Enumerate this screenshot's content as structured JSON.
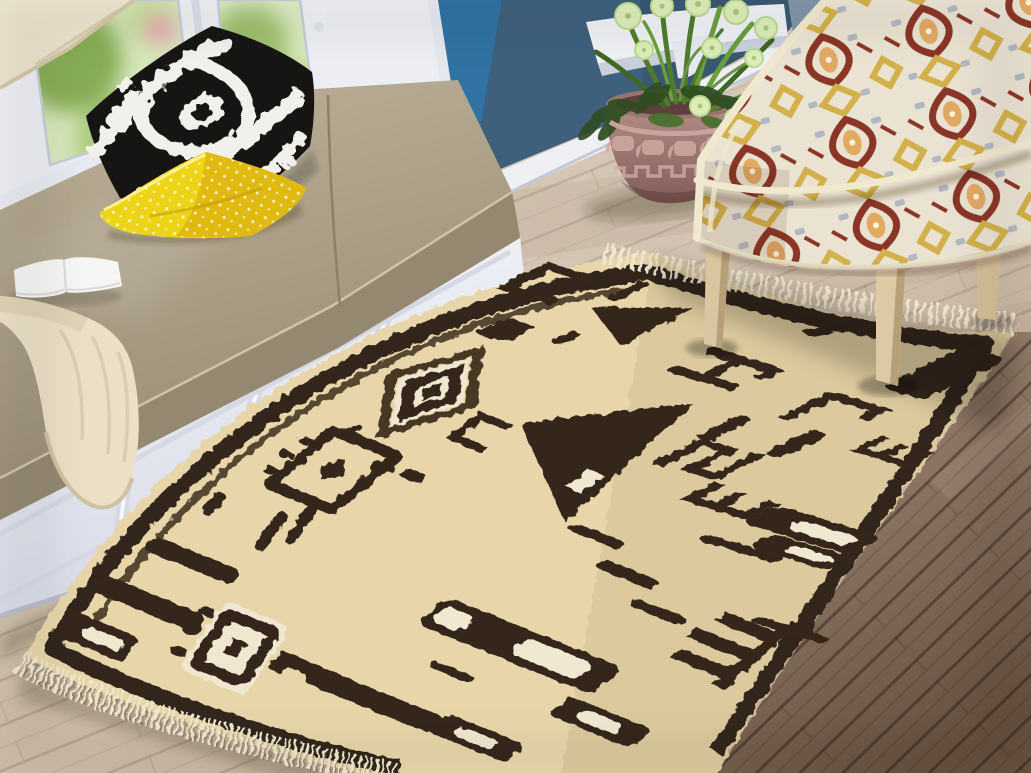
{
  "scene": {
    "type": "interior-photograph",
    "description": "Staged living-room corner photo: cream tribal kilim rug with dark brown motifs on wood floor, white window-seat bench with pillows, potted plant against blue wall, ikat upholstered armchair",
    "objects": [
      {
        "name": "window",
        "detail": "white frame, green garden view, roman shade"
      },
      {
        "name": "window-seat-bench",
        "detail": "white paneled base, taupe cushion"
      },
      {
        "name": "ikat-pillow",
        "detail": "black and white ikat pattern"
      },
      {
        "name": "yellow-pillow",
        "detail": "lemon yellow with white speckle"
      },
      {
        "name": "open-book",
        "detail": "white open paperback on cushion"
      },
      {
        "name": "throw-blanket",
        "detail": "cream knit draped over bench edge"
      },
      {
        "name": "accent-wall",
        "detail": "slate blue painted wall with white baseboard"
      },
      {
        "name": "wall-ledge",
        "detail": "white decorative sill with corbel"
      },
      {
        "name": "potted-plant",
        "detail": "carved mauve pot, grasses and pale green pompom blooms"
      },
      {
        "name": "armchair",
        "detail": "maroon-yellow-cream ikat upholstery, light wood legs"
      },
      {
        "name": "area-rug",
        "detail": "cream moroccan/tribal rug, dark brown glyph motifs, fringe ends"
      },
      {
        "name": "wood-floor",
        "detail": "light oak planks, darker stained planks at right"
      }
    ],
    "rug_motifs": [
      "bracket",
      "square",
      "eye-diamond",
      "triangle",
      "H-glyph",
      "hook",
      "comb-E",
      "meander",
      "trident",
      "bars-with-white-core",
      "square-eye-medallion",
      "slab",
      "dashes"
    ]
  },
  "palette": {
    "floor_light": "#d5c6b4",
    "floor_dark": "#6f5848",
    "wall_blue": "#3e607c",
    "wall_blue_bright": "#2e74a6",
    "trim_white": "#eef0f4",
    "bench_base": "#edeff5",
    "cushion": "#a89c85",
    "pillow_black": "#171513",
    "pillow_white": "#f2f0ea",
    "pillow_yellow": "#edd416",
    "throw_cream": "#ebe0c6",
    "book_white": "#f6f6f4",
    "pot_mauve": "#a57f7c",
    "leaf_green": "#55802f",
    "flower_pale": "#dcedb8",
    "rug_field": "#e8d6aa",
    "rug_motif": "#35281a",
    "rug_white": "#f1e8d2",
    "rug_fringe": "#f0e7cf",
    "chair_cream": "#ece4d2",
    "ikat_maroon": "#8a3526",
    "ikat_yellow": "#d3b049",
    "wood_leg": "#d9c6a0"
  }
}
